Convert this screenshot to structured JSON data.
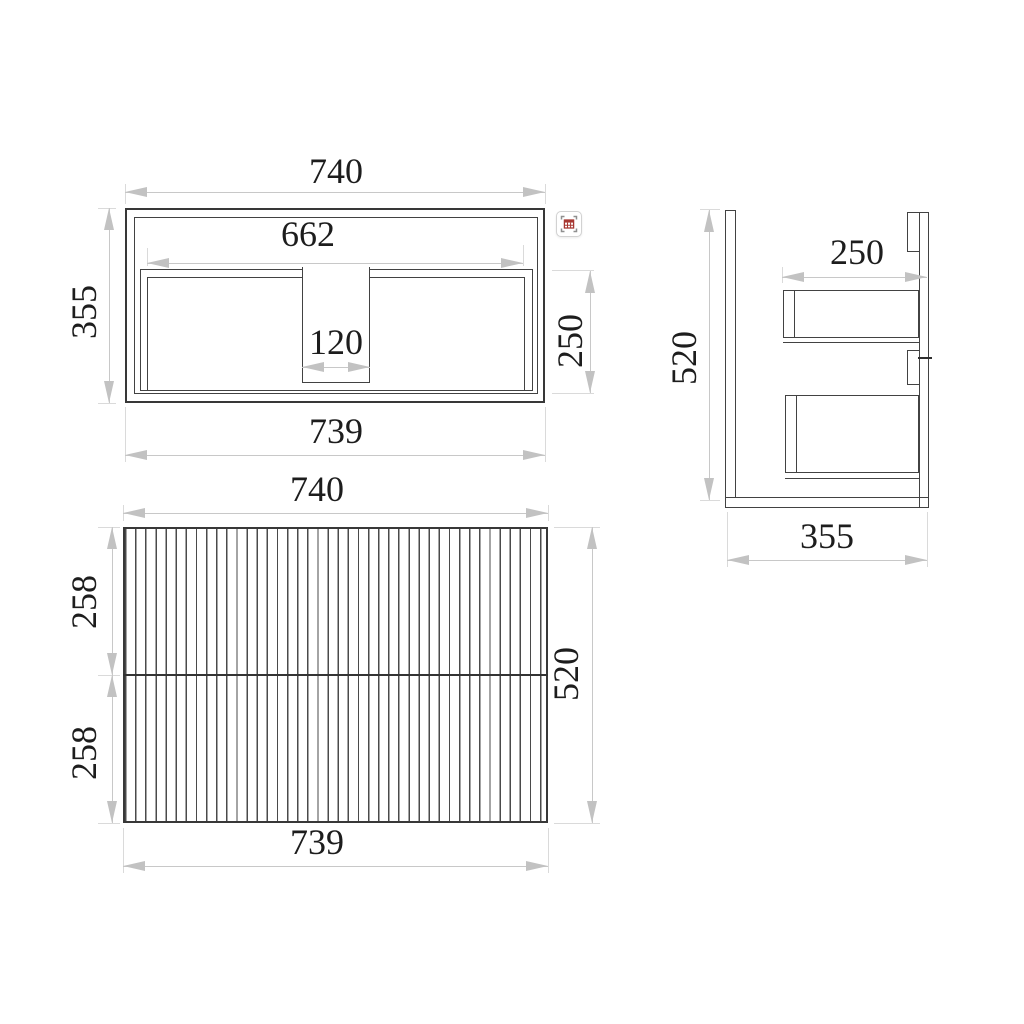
{
  "drawing": {
    "plan": {
      "view_name": "top view",
      "w_top": "740",
      "w_inner": "662",
      "w_notch": "120",
      "d_left": "355",
      "d_inner": "250",
      "w_bottom": "739"
    },
    "side": {
      "view_name": "side view",
      "h_left": "520",
      "d_top": "250",
      "d_bottom": "355"
    },
    "front": {
      "view_name": "front view",
      "w_top": "740",
      "h_upper": "258",
      "h_lower": "258",
      "h_right": "520",
      "w_bottom": "739"
    },
    "icon": {
      "name": "table-scan"
    },
    "colors": {
      "outline": "#383838",
      "dim_line": "#c8c8c8",
      "dim_text": "#1d1d1d",
      "icon_accent": "#a83832"
    }
  }
}
